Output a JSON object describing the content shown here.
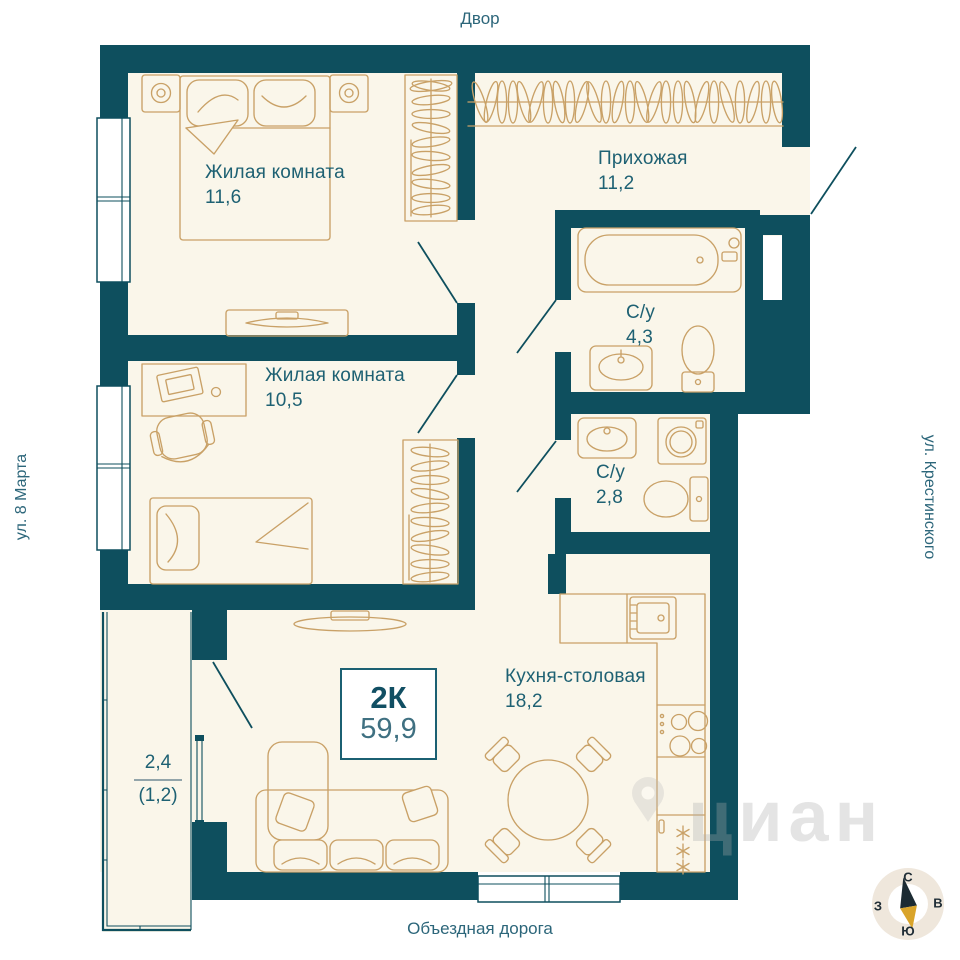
{
  "surroundings": {
    "top_label": "Двор",
    "left_label": "ул. 8 Марта",
    "right_label": "ул. Крестинского",
    "bottom_label": "Объездная дорога"
  },
  "apartment": {
    "type_label": "2К",
    "total_area": "59,9"
  },
  "rooms": {
    "bedroom_1": {
      "name": "Жилая комната",
      "area": "11,6"
    },
    "hallway": {
      "name": "Прихожая",
      "area": "11,2"
    },
    "bathroom_1": {
      "name": "С/у",
      "area": "4,3"
    },
    "bathroom_2": {
      "name": "С/у",
      "area": "2,8"
    },
    "bedroom_2": {
      "name": "Жилая комната",
      "area": "10,5"
    },
    "kitchen": {
      "name": "Кухня-столовая",
      "area": "18,2"
    },
    "balcony": {
      "area": "2,4",
      "area_reduced": "(1,2)"
    }
  },
  "compass": {
    "north": "С",
    "east": "В",
    "south": "Ю",
    "west": "З"
  },
  "watermark": "циан",
  "colors": {
    "wall": "#0e4f5e",
    "floor": "#faf6ea",
    "furniture_line": "#c9a167",
    "label_text": "#1e6173",
    "compass_needle_north": "#1c2b33",
    "compass_needle_south": "#d9a42a"
  }
}
